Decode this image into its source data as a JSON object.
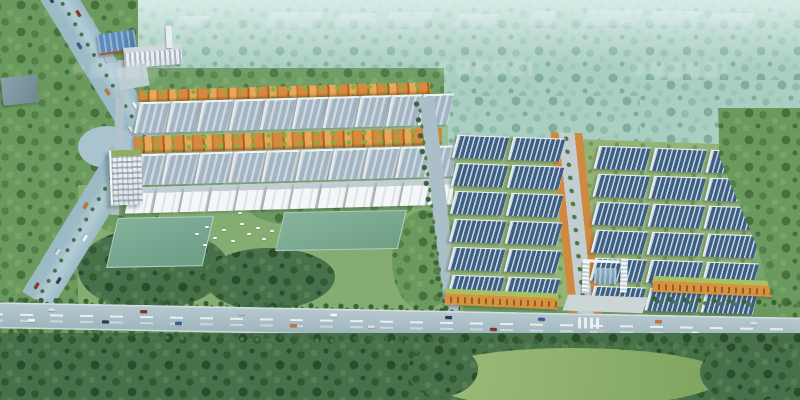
{
  "meta": {
    "description": "Aerial perspective architectural rendering of a large industrial logistics park surrounded by forest, with rows of warehouses, orange commercial strips, a central landscaped avenue, an entrance gate, sports fields, a highway and a main road with traffic",
    "image_type": "architectural-rendering",
    "view": "bird's-eye"
  },
  "watermark": {
    "present": true,
    "legible": false,
    "count": 3
  },
  "palette": {
    "haze_top": "#c2ddd8",
    "forest_haze": "#a9cec2",
    "forest_mid": "#6b9a5e",
    "forest_dark": "#47714a",
    "lawn": "#85ad72",
    "lawn_bright": "#9dbd7a",
    "field_turf": "#79a78f",
    "road": "#a9bec6",
    "highway": "#a3c0cd",
    "roof_gray": "#a3b4c2",
    "roof_ridge": "#cdd8e1",
    "roof_blue": "#3c5f82",
    "facade_orange": "#d68a3e",
    "facade_white": "#f4f6f7",
    "green_roof": "#a6c162",
    "factory_blue": "#5b8cbb",
    "accent_red": "#b0522f",
    "office_white": "#eef2f4",
    "glass_blue": "#7ba3bf",
    "car_colors": [
      "#f2f5f7",
      "#d6dce1",
      "#2f3e4e",
      "#8a3226",
      "#3a5a90",
      "#b9c2c9",
      "#c8742e"
    ]
  },
  "scene": {
    "left_cluster": {
      "orange_rows": 2,
      "gray_warehouse_rows": 2,
      "units_per_row": 10,
      "white_row_units": 12
    },
    "right_cluster": {
      "rows": 6,
      "west_cols": 2,
      "east_cols": 3
    },
    "shops_segments": 2,
    "entrance_gate": 1,
    "office_tower": 1,
    "factory_buildings": 2,
    "sports_fields": 2,
    "birds": 12,
    "distant_blocks": 9,
    "cars_main_road": 16,
    "cars_highway": 14
  }
}
